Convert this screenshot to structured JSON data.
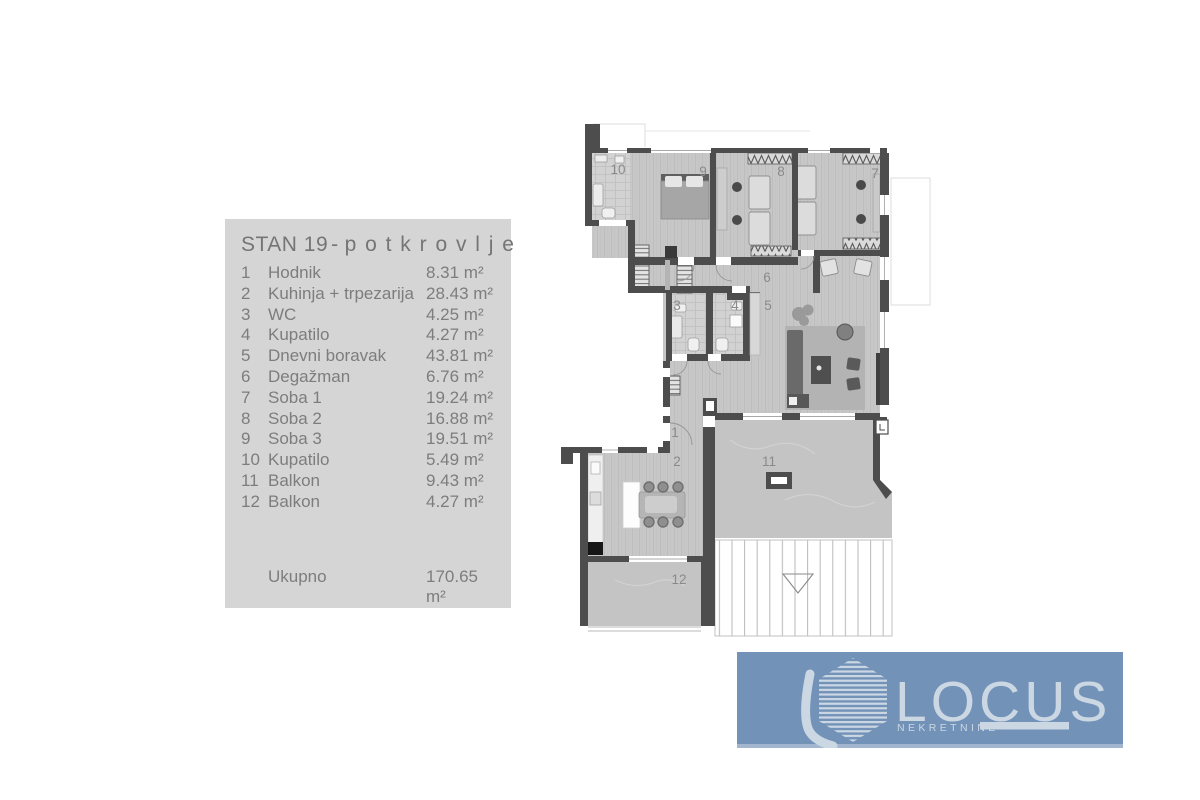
{
  "panel": {
    "title": {
      "main": "STAN 19",
      "separator": "-",
      "sub": "potkrovlje"
    },
    "rows": [
      {
        "num": "1",
        "name": "Hodnik",
        "area": "8.31 m²"
      },
      {
        "num": "2",
        "name": "Kuhinja + trpezarija",
        "area": "28.43 m²"
      },
      {
        "num": "3",
        "name": "WC",
        "area": "4.25 m²"
      },
      {
        "num": "4",
        "name": "Kupatilo",
        "area": "4.27 m²"
      },
      {
        "num": "5",
        "name": "Dnevni boravak",
        "area": "43.81 m²"
      },
      {
        "num": "6",
        "name": "Degažman",
        "area": "6.76 m²"
      },
      {
        "num": "7",
        "name": "Soba 1",
        "area": "19.24 m²"
      },
      {
        "num": "8",
        "name": "Soba 2",
        "area": "16.88 m²"
      },
      {
        "num": "9",
        "name": "Soba 3",
        "area": "19.51 m²"
      },
      {
        "num": "10",
        "name": "Kupatilo",
        "area": "5.49 m²"
      },
      {
        "num": "11",
        "name": "Balkon",
        "area": "9.43 m²"
      },
      {
        "num": "12",
        "name": "Balkon",
        "area": "4.27 m²"
      }
    ],
    "total": {
      "label": "Ukupno",
      "area": "170.65 m²"
    }
  },
  "plan": {
    "rooms": [
      {
        "num": "1"
      },
      {
        "num": "2"
      },
      {
        "num": "3"
      },
      {
        "num": "4"
      },
      {
        "num": "5"
      },
      {
        "num": "6"
      },
      {
        "num": "7"
      },
      {
        "num": "8"
      },
      {
        "num": "9"
      },
      {
        "num": "10"
      },
      {
        "num": "11"
      },
      {
        "num": "12"
      }
    ]
  },
  "logo": {
    "brand": "LOCUS",
    "tagline": "NEKRETNINE"
  },
  "colors": {
    "logo_bg": "#7292b8",
    "logo_fg": "#ccd7e4",
    "panel_bg": "#d5d5d5",
    "panel_text": "#7b7b7b",
    "wall": "#4d4d4d",
    "floor": "#c7c7c7",
    "tile": "#d2d2d2",
    "balcony": "#c4c4c4"
  }
}
